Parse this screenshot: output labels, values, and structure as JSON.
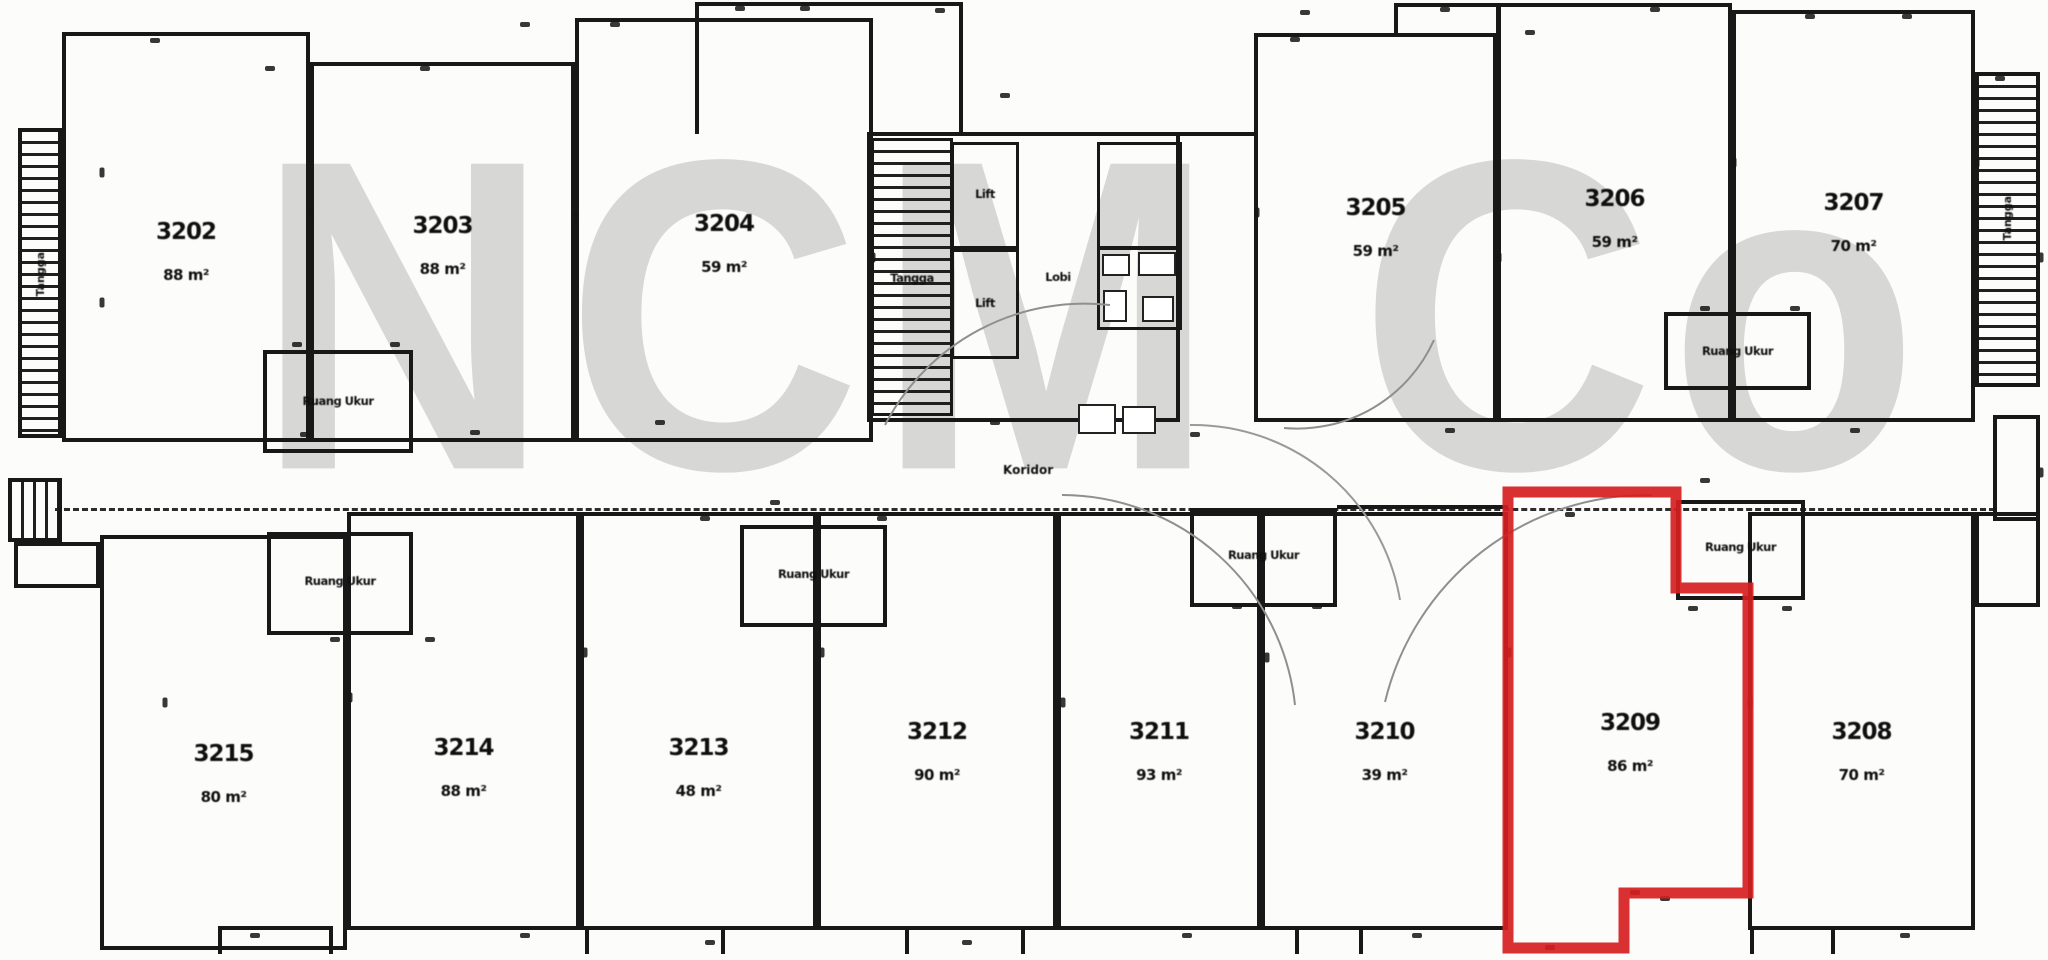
{
  "watermark": {
    "text": "NCM Co"
  },
  "plan": {
    "corridor_label": "Koridor",
    "labels": {
      "stairs": "Tangga",
      "lift": "Lift",
      "lobby": "Lobi",
      "service_room": "Ruang Ukur"
    },
    "highlight_color": "#d61f1f",
    "highlighted_unit": "3209",
    "units": [
      {
        "number": "3202",
        "area": "88 m²"
      },
      {
        "number": "3203",
        "area": "88 m²"
      },
      {
        "number": "3204",
        "area": "59 m²"
      },
      {
        "number": "3205",
        "area": "59 m²"
      },
      {
        "number": "3206",
        "area": "59 m²"
      },
      {
        "number": "3207",
        "area": "70 m²"
      },
      {
        "number": "3208",
        "area": "70 m²"
      },
      {
        "number": "3209",
        "area": "86 m²"
      },
      {
        "number": "3210",
        "area": "39 m²"
      },
      {
        "number": "3211",
        "area": "93 m²"
      },
      {
        "number": "3212",
        "area": "90 m²"
      },
      {
        "number": "3213",
        "area": "48 m²"
      },
      {
        "number": "3214",
        "area": "88 m²"
      },
      {
        "number": "3215",
        "area": "80 m²"
      }
    ]
  }
}
